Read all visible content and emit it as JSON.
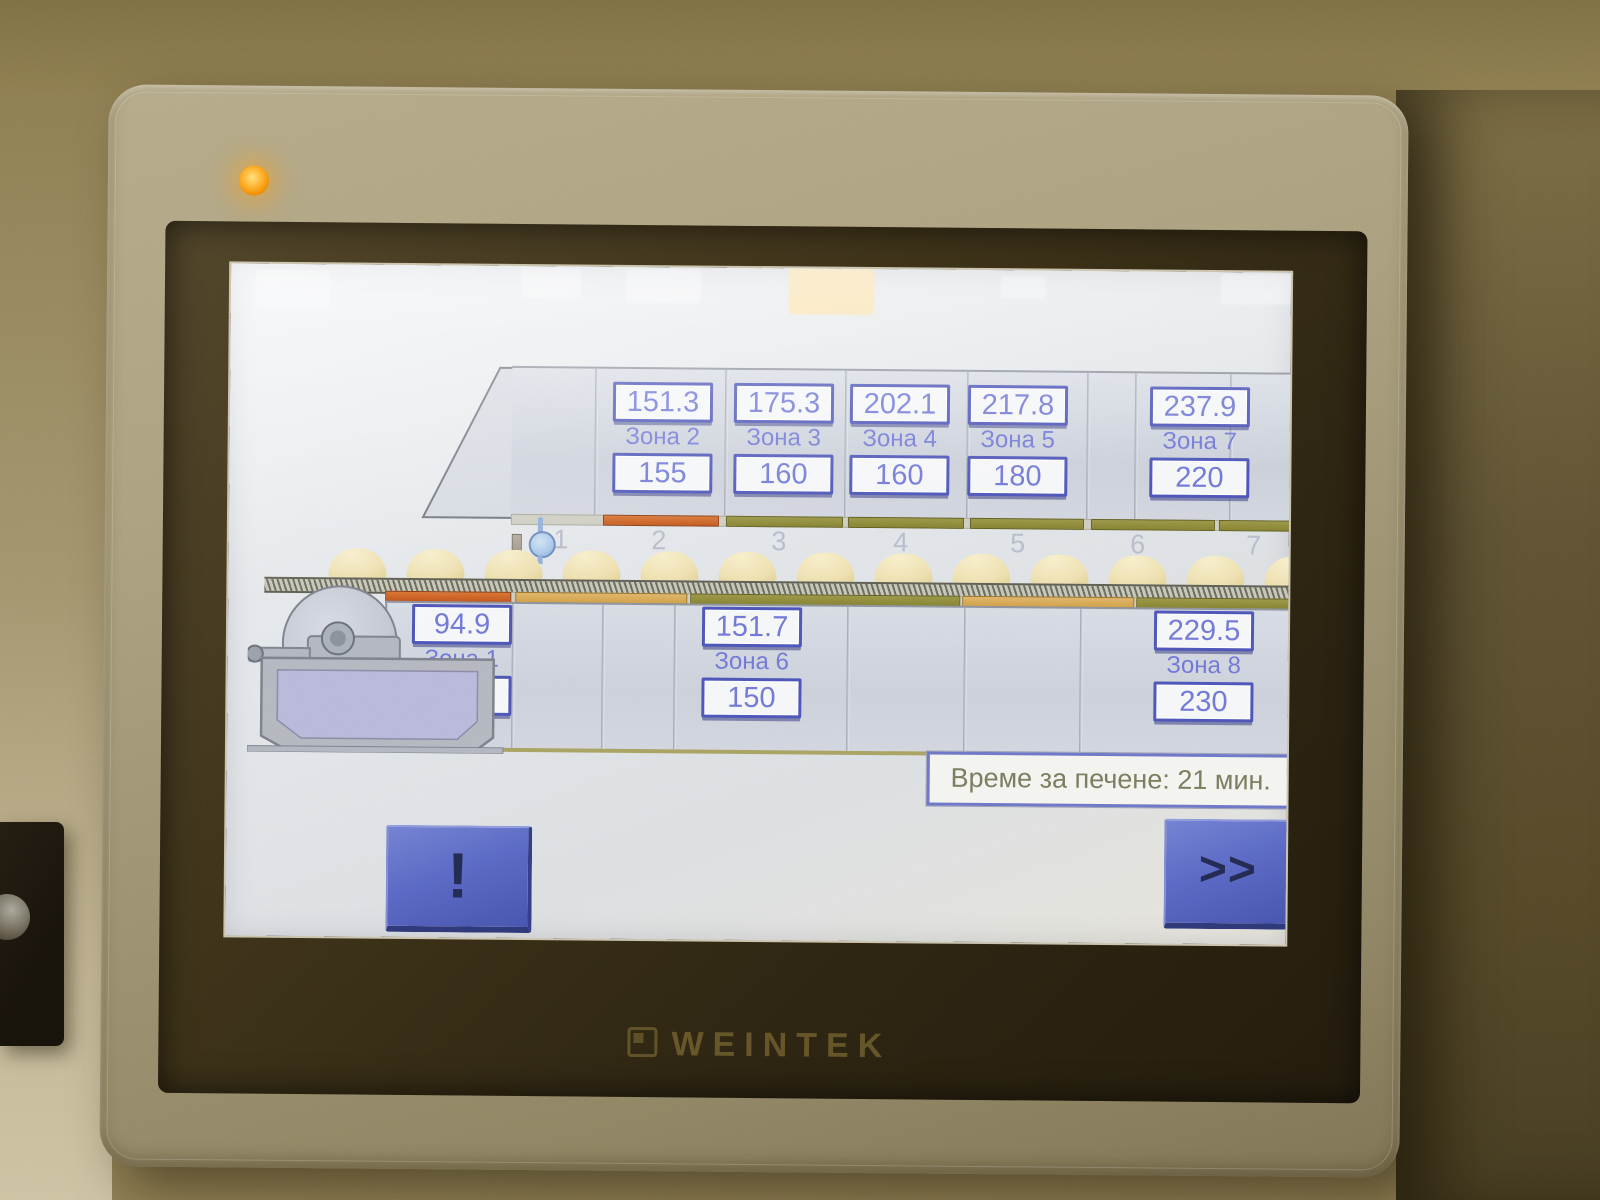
{
  "device": {
    "brand_logo": "WEINTEK",
    "power_led": "orange-on"
  },
  "hmi": {
    "zones_top": [
      {
        "label": "Зона 2",
        "pv": "151.3",
        "sv": "155"
      },
      {
        "label": "Зона 3",
        "pv": "175.3",
        "sv": "160"
      },
      {
        "label": "Зона 4",
        "pv": "202.1",
        "sv": "160"
      },
      {
        "label": "Зона 5",
        "pv": "217.8",
        "sv": "180"
      },
      {
        "label": "Зона 7",
        "pv": "237.9",
        "sv": "220"
      }
    ],
    "zones_bottom": [
      {
        "label": "Зона 1",
        "pv": "94.9",
        "sv": "120"
      },
      {
        "label": "Зона 6",
        "pv": "151.7",
        "sv": "150"
      },
      {
        "label": "Зона 8",
        "pv": "229.5",
        "sv": "230"
      }
    ],
    "conveyor_section_numbers": [
      "1",
      "2",
      "3",
      "4",
      "5",
      "6",
      "7"
    ],
    "bake_time_text": "Време за печене: 21 мин.",
    "buttons": {
      "alarm": "!",
      "next": ">>"
    }
  },
  "colors": {
    "zone_value_text": "#7077d6",
    "zone_box_border": "#4d55b8",
    "button_blue": "#5a68c4",
    "bar_orange": "#c85c22",
    "bar_gold": "#d8a855",
    "bar_olive": "#8f8c3a",
    "led_orange": "#ffa31a",
    "bake_time_text": "#7b7a5e"
  }
}
